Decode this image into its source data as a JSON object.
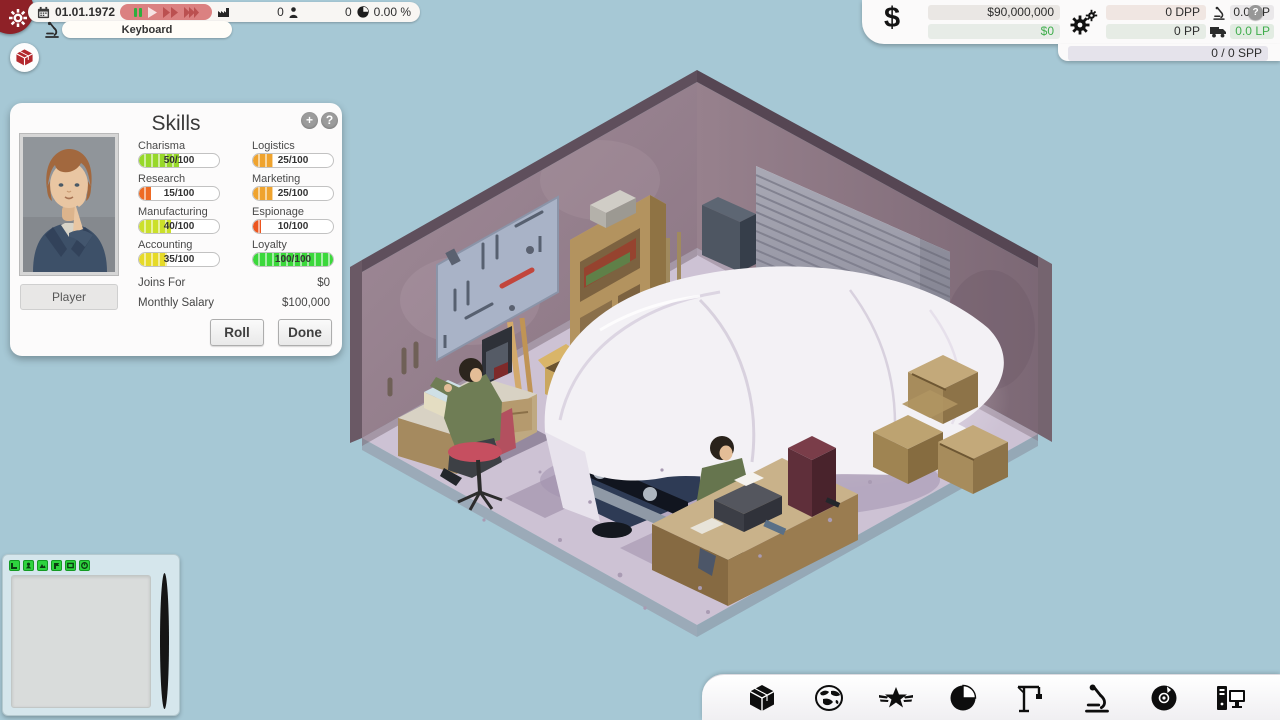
{
  "top_bar": {
    "date": "01.01.1972",
    "speed_controls": [
      "pause",
      "play",
      "fast",
      "fastest"
    ],
    "counters": [
      {
        "icon": "factory-icon",
        "value": "0"
      },
      {
        "icon": "person-icon",
        "value": "0"
      },
      {
        "icon": "pie-icon",
        "value": "0.00 %"
      }
    ],
    "research_pill": "Keyboard"
  },
  "top_right": {
    "currency_symbol": "$",
    "money": "$90,000,000",
    "money_delta": "$0",
    "dpp": "0 DPP",
    "pp": "0 PP",
    "rp": "0.0 RP",
    "lp": "0.0 LP",
    "spp": "0 / 0 SPP",
    "help_label": "?"
  },
  "skills_panel": {
    "title": "Skills",
    "add_label": "+",
    "help_label": "?",
    "portrait_button": "Player",
    "skills": [
      {
        "name": "Charisma",
        "value": 50,
        "max": 100,
        "display": "50/100",
        "color": "#97d82a"
      },
      {
        "name": "Logistics",
        "value": 25,
        "max": 100,
        "display": "25/100",
        "color": "#efa32e"
      },
      {
        "name": "Research",
        "value": 15,
        "max": 100,
        "display": "15/100",
        "color": "#ee6a24"
      },
      {
        "name": "Marketing",
        "value": 25,
        "max": 100,
        "display": "25/100",
        "color": "#efa32e"
      },
      {
        "name": "Manufacturing",
        "value": 40,
        "max": 100,
        "display": "40/100",
        "color": "#cbe02a"
      },
      {
        "name": "Espionage",
        "value": 10,
        "max": 100,
        "display": "10/100",
        "color": "#ec551f"
      },
      {
        "name": "Accounting",
        "value": 35,
        "max": 100,
        "display": "35/100",
        "color": "#e6da28"
      },
      {
        "name": "Loyalty",
        "value": 100,
        "max": 100,
        "display": "100/100",
        "color": "#3bd83b"
      }
    ],
    "joins_for_label": "Joins For",
    "joins_for_value": "$0",
    "salary_label": "Monthly Salary",
    "salary_value": "$100,000",
    "roll_label": "Roll",
    "done_label": "Done"
  },
  "toolbar": {
    "icons": [
      "products-box-icon",
      "world-map-icon",
      "winged-star-icon",
      "market-pie-icon",
      "construction-crane-icon",
      "research-microscope-icon",
      "software-disc-icon",
      "hardware-computer-icon"
    ]
  },
  "minimap": {
    "layer_buttons": 6
  },
  "colors": {
    "accent_green": "#3fae4c",
    "speed_pill_red": "#db8181",
    "background_sky": "#a6c8d5",
    "minimap_button_green": "#2ed33e"
  }
}
